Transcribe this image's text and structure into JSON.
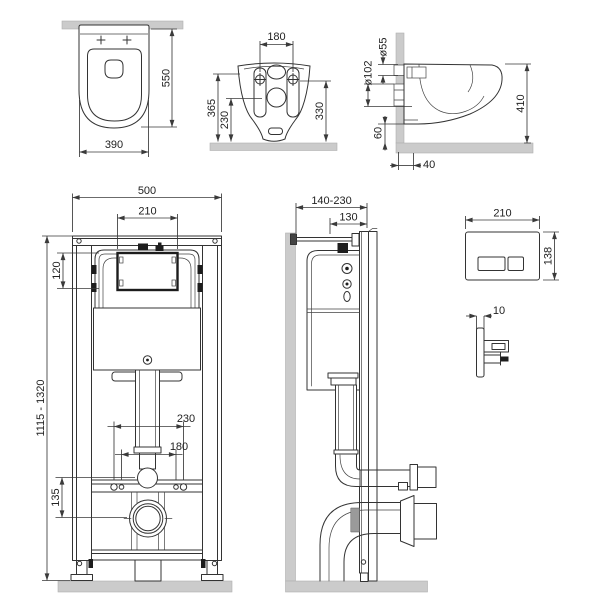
{
  "drawing_title": "wall-hung-toilet-installation-drawing",
  "colors": {
    "line": "#333333",
    "text": "#222222",
    "wall_fill": "#cbcbcb",
    "accent_dark": "#1d1d1d"
  },
  "labels": {
    "bowl_height": "550",
    "bowl_width": "390",
    "rear_hole_spacing": "180",
    "rear_height": "365",
    "rear_drain_height": "230",
    "rear_hole_height": "330",
    "side_flush_dia": "ø55",
    "side_drain_dia": "ø102",
    "side_depth": "410",
    "side_bottom_gap": "60",
    "side_wall_offset": "40",
    "frame_width": "500",
    "frame_window_width": "210",
    "frame_top_offset": "120",
    "frame_height_range": "1115 - 1320",
    "frame_bolt_spacing_outer": "230",
    "frame_bolt_spacing_inner": "180",
    "frame_drain_offset": "135",
    "frame_depth_range": "140-230",
    "frame_depth": "130",
    "plate_width": "210",
    "plate_height": "138",
    "plate_thickness": "10"
  }
}
